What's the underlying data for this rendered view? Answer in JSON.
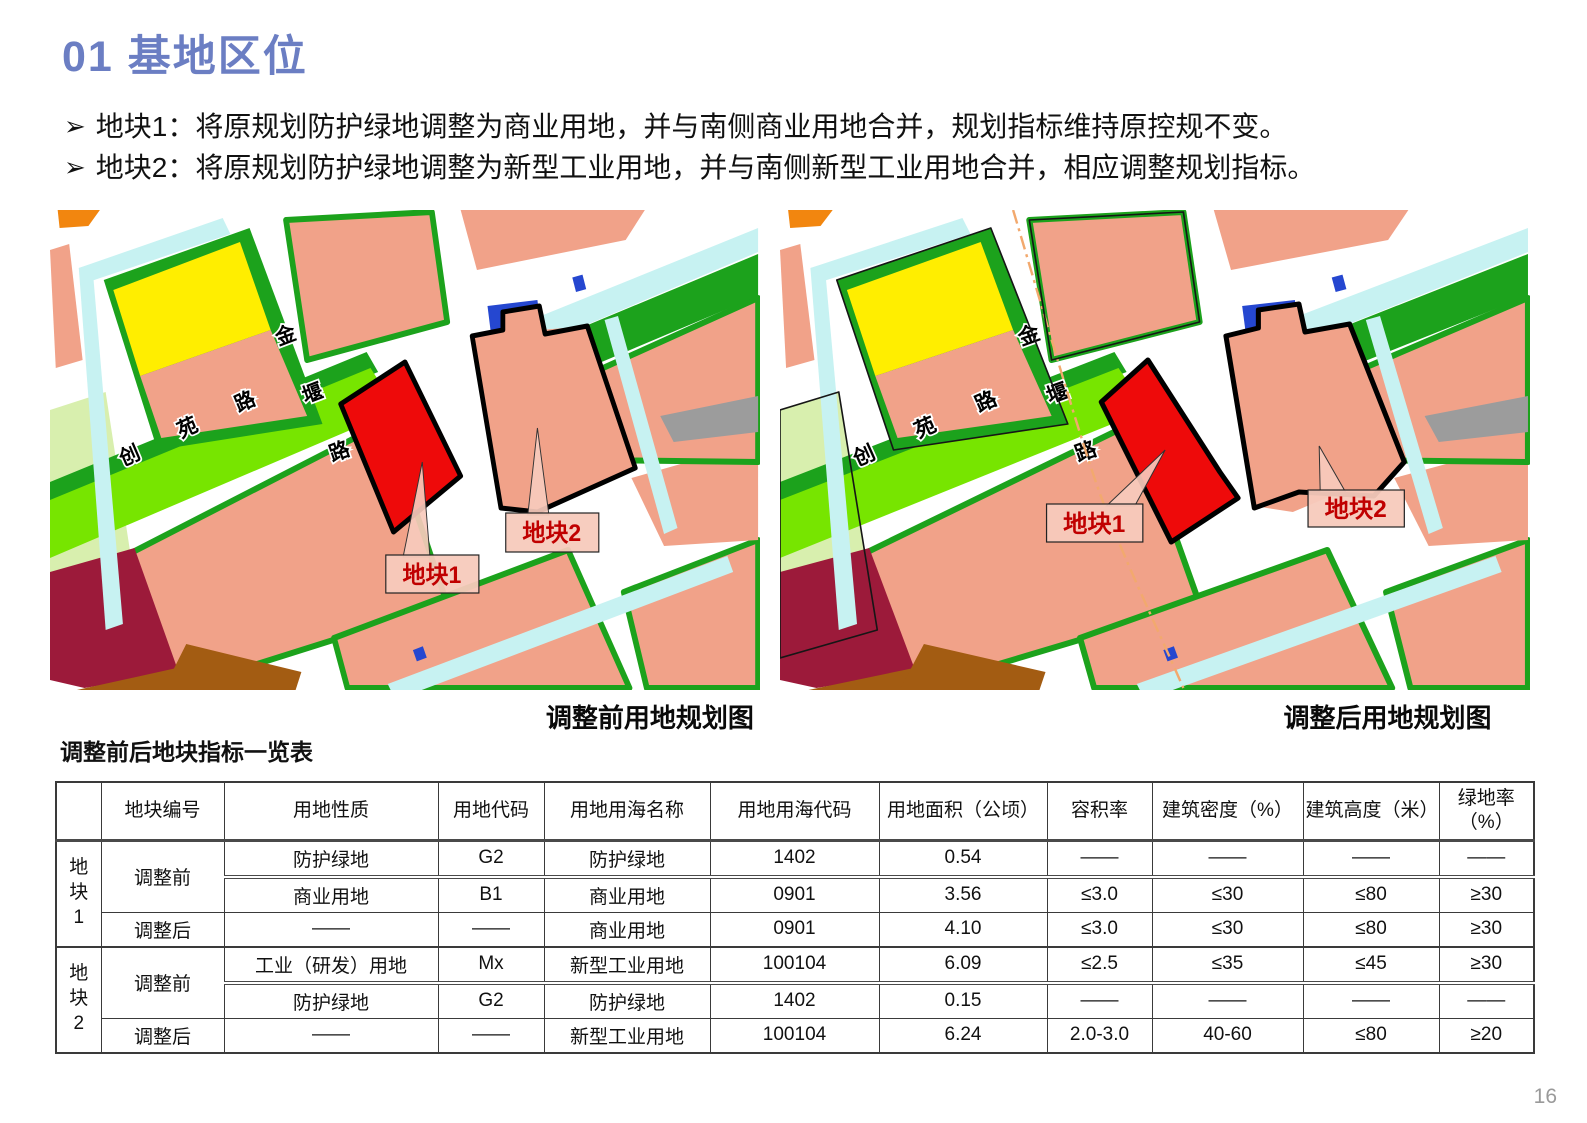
{
  "page": {
    "title": "01 基地区位",
    "page_number": "16"
  },
  "ui": {
    "bullet_marker": "➢"
  },
  "bullets": [
    "地块1：将原规划防护绿地调整为商业用地，并与南侧商业用地合并，规划指标维持原控规不变。",
    "地块2：将原规划防护绿地调整为新型工业用地，并与南侧新型工业用地合并，相应调整规划指标。"
  ],
  "maps": {
    "road_jinyan": [
      "金",
      "堰",
      "路"
    ],
    "road_chuangyuan": [
      "创",
      "苑",
      "路"
    ],
    "before": {
      "caption": "调整前用地规划图",
      "plot1_label": "地块1",
      "plot2_label": "地块2"
    },
    "after": {
      "caption": "调整后用地规划图",
      "plot1_label": "地块1",
      "plot2_label": "地块2"
    }
  },
  "table": {
    "title": "调整前后地块指标一览表",
    "headers": [
      "",
      "地块编号",
      "用地性质",
      "用地代码",
      "用地用海名称",
      "用地用海代码",
      "用地面积（公顷）",
      "容积率",
      "建筑密度（%）",
      "建筑高度（米）",
      "绿地率（%）"
    ],
    "plot1": "地块1",
    "plot2": "地块2",
    "pre": "调整前",
    "post": "调整后",
    "rows": [
      [
        "防护绿地",
        "G2",
        "防护绿地",
        "1402",
        "0.54",
        "——",
        "——",
        "——",
        "——"
      ],
      [
        "商业用地",
        "B1",
        "商业用地",
        "0901",
        "3.56",
        "≤3.0",
        "≤30",
        "≤80",
        "≥30"
      ],
      [
        "——",
        "——",
        "商业用地",
        "0901",
        "4.10",
        "≤3.0",
        "≤30",
        "≤80",
        "≥30"
      ],
      [
        "工业（研发）用地",
        "Mx",
        "新型工业用地",
        "100104",
        "6.09",
        "≤2.5",
        "≤35",
        "≤45",
        "≥30"
      ],
      [
        "防护绿地",
        "G2",
        "防护绿地",
        "1402",
        "0.15",
        "——",
        "——",
        "——",
        "——"
      ],
      [
        "——",
        "——",
        "新型工业用地",
        "100104",
        "6.24",
        "2.0-3.0",
        "40-60",
        "≤80",
        "≥20"
      ]
    ]
  },
  "colors": {
    "title_blue": "#6b7ec3",
    "salmon": "#f1a289",
    "yellow": "#ffee00",
    "green": "#1ca21c",
    "lgreen": "#77e500",
    "pgreen": "#d8efae",
    "cyan": "#c7f2f2",
    "blue": "#2547d0",
    "maroon": "#9c1a3a",
    "brown": "#a35c12",
    "gray": "#9c9c9c",
    "orange": "#f2860f",
    "red": "#ee0a0a",
    "label_red": "#c00000",
    "label_bg": "#f7cabc",
    "dash_orange": "#f2a96e"
  }
}
